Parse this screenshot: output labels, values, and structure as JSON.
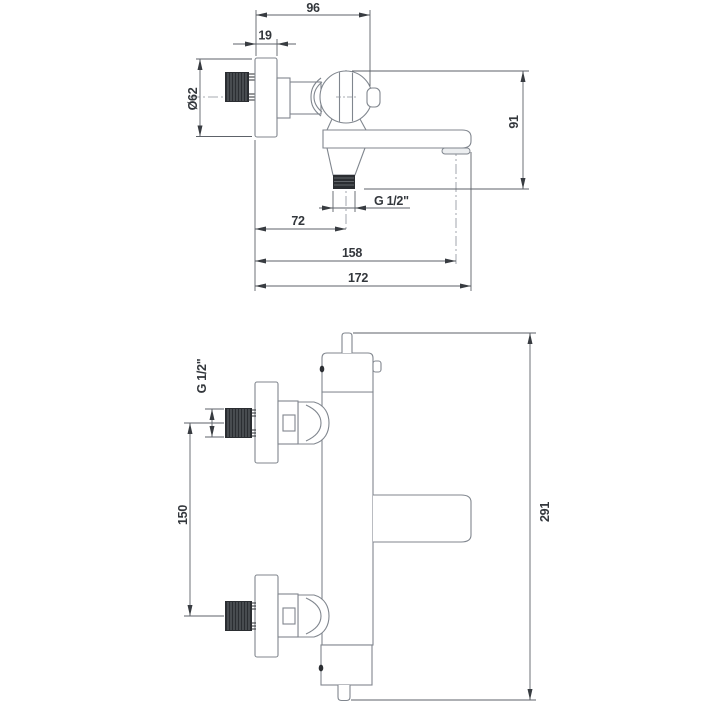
{
  "drawing": {
    "kind": "technical-dimension-drawing",
    "views": {
      "top": {
        "label": "wall-mounted bath mixer - side view",
        "dims": {
          "depth_total": "96",
          "plate_depth": "19",
          "plate_diameter": "Ø62",
          "height": "91",
          "outlet_thread": "G 1/2\"",
          "outlet_offset": "72",
          "aerator_reach": "158",
          "spout_reach": "172"
        }
      },
      "bottom": {
        "label": "thermostatic mixer column - side view",
        "dims": {
          "inlet_thread": "G 1/2\"",
          "inlet_spacing": "150",
          "total_height": "291"
        }
      }
    }
  }
}
